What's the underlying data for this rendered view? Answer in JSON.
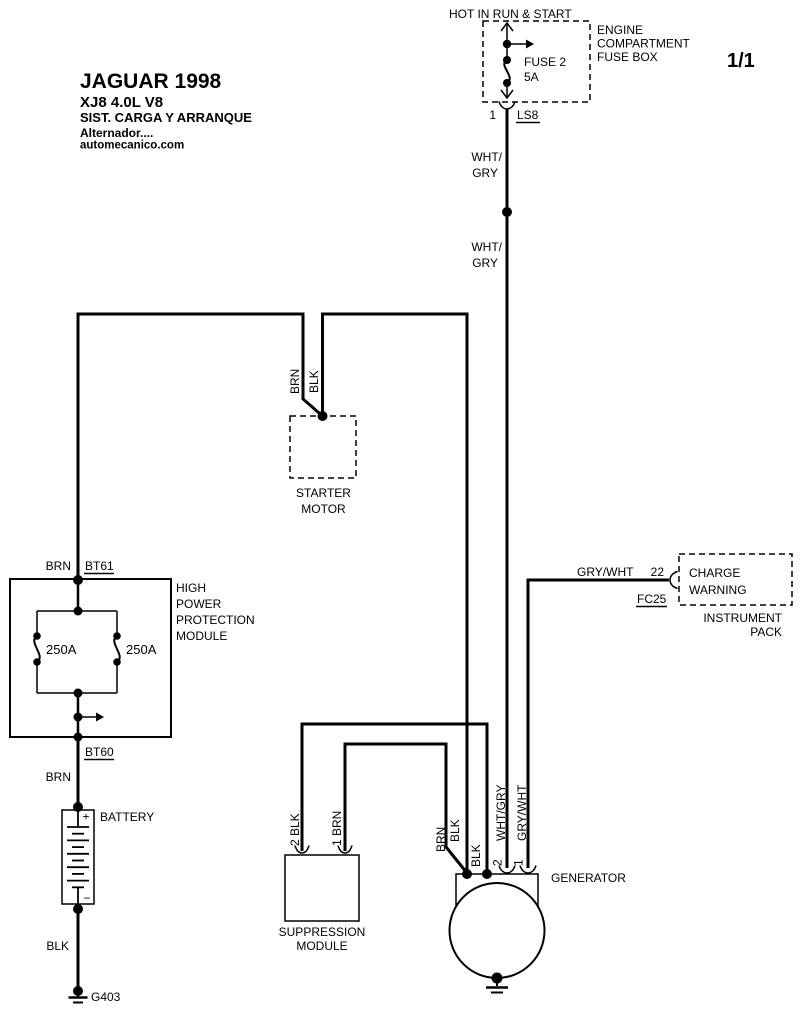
{
  "colors": {
    "ink": "#000000",
    "paper": "#ffffff"
  },
  "header": {
    "hot_label": "HOT IN RUN & START",
    "box_name_l1": "ENGINE",
    "box_name_l2": "COMPARTMENT",
    "box_name_l3": "FUSE BOX",
    "fuse_label": "FUSE 2",
    "fuse_rating": "5A",
    "pin": "1",
    "connector": "LS8",
    "page": "1/1"
  },
  "title_block": {
    "l1": "JAGUAR 1998",
    "l2": "XJ8  4.0L  V8",
    "l3": "SIST. CARGA Y ARRANQUE",
    "l4": "Alternador....",
    "l5": "automecanico.com"
  },
  "feed_wire": {
    "upper_l1": "WHT/",
    "upper_l2": "GRY",
    "lower_l1": "WHT/",
    "lower_l2": "GRY"
  },
  "starter": {
    "wire_left": "BRN",
    "wire_right": "BLK",
    "name_l1": "STARTER",
    "name_l2": "MOTOR"
  },
  "protection_module": {
    "wire_in": "BRN",
    "conn_in": "BT61",
    "conn_out": "BT60",
    "name_l1": "HIGH",
    "name_l2": "POWER",
    "name_l3": "PROTECTION",
    "name_l4": "MODULE",
    "fuse_left": "250A",
    "fuse_right": "250A"
  },
  "battery": {
    "wire_in": "BRN",
    "label": "BATTERY",
    "plus": "+",
    "minus": "−",
    "wire_out": "BLK",
    "ground": "G403"
  },
  "instrument_pack": {
    "wire": "GRY/WHT",
    "pin": "22",
    "connector": "FC25",
    "charge_l1": "CHARGE",
    "charge_l2": "WARNING",
    "name_l1": "INSTRUMENT",
    "name_l2": "PACK"
  },
  "suppression": {
    "pin2": "2 BLK",
    "pin1": "1 BRN",
    "name_l1": "SUPPRESSION",
    "name_l2": "MODULE"
  },
  "generator": {
    "label": "GENERATOR",
    "wire_brn": "BRN",
    "wire_blk_a": "BLK",
    "wire_blk_b": "BLK",
    "pin2": "2",
    "pin2_wire": "WHT/GRY",
    "pin1": "1",
    "pin1_wire": "GRY/WHT"
  }
}
